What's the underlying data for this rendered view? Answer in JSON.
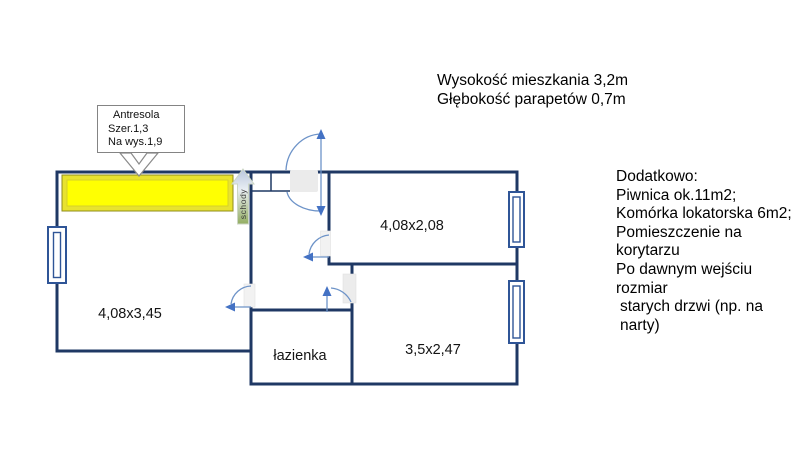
{
  "info_top": {
    "line1": "Wysokość mieszkania 3,2m",
    "line2": "Głębokość parapetów 0,7m"
  },
  "additional_info": {
    "title": "Dodatkowo:",
    "lines": [
      "Piwnica ok.11m2;",
      "Komórka lokatorska 6m2;",
      "Pomieszczenie na korytarzu",
      "Po dawnym wejściu rozmiar",
      "starych drzwi (np. na narty)"
    ]
  },
  "callout": {
    "line1": "Antresola",
    "line2": "Szer.1,3",
    "line3": "Na wys.1,9"
  },
  "rooms": {
    "living_room_dimensions": "4,08x3,45",
    "top_right_room_dimensions": "4,08x2,08",
    "bottom_right_room_dimensions": "3,5x2,47",
    "bathroom_label": "łazienka"
  },
  "stairs_label": "schody",
  "colors": {
    "wall": "#1f3864",
    "window_stroke": "#2f5597",
    "door_arc": "#6d93c8",
    "door_arrow": "#4472c4",
    "antresola_fill": "#ffff02",
    "antresola_frame": "#e8e22f",
    "stairs_green": "#93ad62"
  }
}
